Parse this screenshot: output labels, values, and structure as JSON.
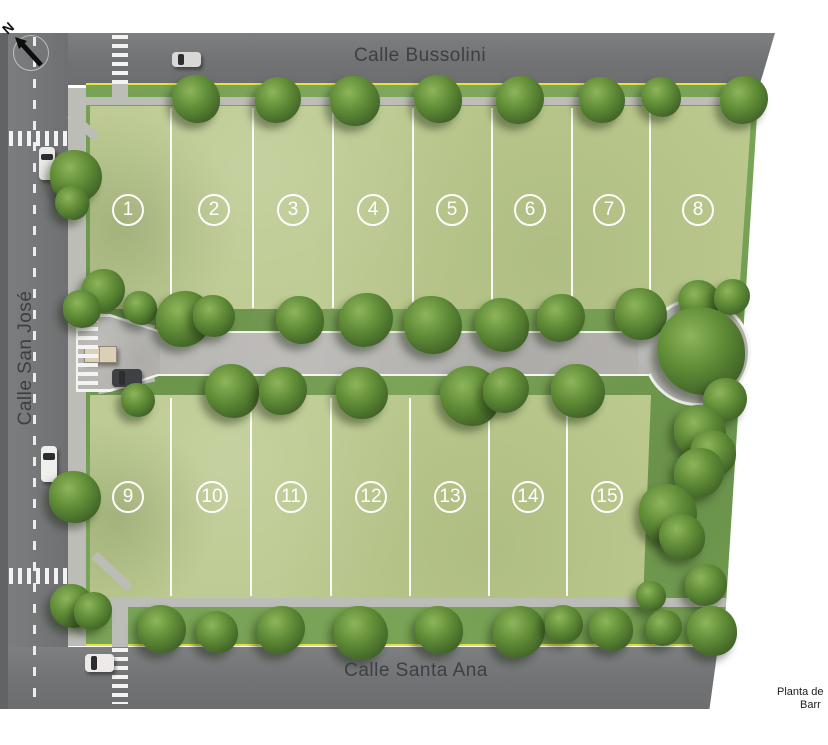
{
  "streets": {
    "top": "Calle Bussolini",
    "left": "Calle San José",
    "bottom": "Calle Santa Ana"
  },
  "caption": {
    "line1": "Planta de",
    "line2": "Barr"
  },
  "compass": {
    "label": "N"
  },
  "colors": {
    "road": "#707274",
    "internal_street": "#b6b5b2",
    "sidewalk": "#bdbdb7",
    "lot_grass": "#bbc98f",
    "verge_green": "#79a356",
    "tree_green": "#4a7030",
    "curb_yellow": "#e3e43e",
    "marker_white": "#ffffff",
    "label_text": "#3d3f43"
  },
  "lots": {
    "marker_y_top": 210,
    "marker_y_bottom": 497,
    "top_row": [
      {
        "num": "1",
        "x": 128
      },
      {
        "num": "2",
        "x": 214
      },
      {
        "num": "3",
        "x": 293
      },
      {
        "num": "4",
        "x": 373
      },
      {
        "num": "5",
        "x": 452
      },
      {
        "num": "6",
        "x": 530
      },
      {
        "num": "7",
        "x": 609
      },
      {
        "num": "8",
        "x": 698
      }
    ],
    "bottom_row": [
      {
        "num": "9",
        "x": 128
      },
      {
        "num": "10",
        "x": 212
      },
      {
        "num": "11",
        "x": 291
      },
      {
        "num": "12",
        "x": 371
      },
      {
        "num": "13",
        "x": 450
      },
      {
        "num": "14",
        "x": 528
      },
      {
        "num": "15",
        "x": 607
      }
    ]
  },
  "dividers": {
    "top": {
      "xs": [
        170,
        252,
        332,
        412,
        491,
        571,
        649
      ],
      "y1": 108,
      "y2": 308
    },
    "bottom": {
      "xs": [
        170,
        250,
        330,
        409,
        488,
        566
      ],
      "y1": 398,
      "y2": 596
    }
  },
  "paths": [
    {
      "x": 86,
      "y": 97,
      "w": 661,
      "h": 8,
      "rot": 0
    },
    {
      "x": 68,
      "y": 88,
      "w": 18,
      "h": 558,
      "rot": 0
    },
    {
      "x": 86,
      "y": 598,
      "w": 640,
      "h": 9,
      "rot": 0
    },
    {
      "x": 112,
      "y": 84,
      "w": 16,
      "h": 15,
      "rot": 0
    },
    {
      "x": 112,
      "y": 606,
      "w": 16,
      "h": 41,
      "rot": 0
    },
    {
      "x": 66,
      "y": 121,
      "w": 34,
      "h": 9,
      "rot": 42
    },
    {
      "x": 88,
      "y": 567,
      "w": 48,
      "h": 9,
      "rot": 43
    },
    {
      "x": 97,
      "y": 319,
      "w": 58,
      "h": 9,
      "rot": 13
    },
    {
      "x": 97,
      "y": 379,
      "w": 58,
      "h": 9,
      "rot": -13
    }
  ],
  "crosswalks": [
    {
      "x": 112,
      "y": 35,
      "w": 16,
      "h": 49,
      "dir": "v"
    },
    {
      "x": 9,
      "y": 131,
      "w": 59,
      "h": 15,
      "dir": "h"
    },
    {
      "x": 78,
      "y": 318,
      "w": 20,
      "h": 72,
      "dir": "v"
    },
    {
      "x": 9,
      "y": 568,
      "w": 59,
      "h": 16,
      "dir": "h"
    },
    {
      "x": 112,
      "y": 648,
      "w": 16,
      "h": 56,
      "dir": "v"
    }
  ],
  "cars": [
    {
      "x": 172,
      "y": 52,
      "w": 29,
      "h": 15,
      "color": "#d8d8d6"
    },
    {
      "x": 39,
      "y": 147,
      "w": 16,
      "h": 33,
      "color": "#eaeae8"
    },
    {
      "x": 41,
      "y": 446,
      "w": 16,
      "h": 36,
      "color": "#efefed"
    },
    {
      "x": 112,
      "y": 369,
      "w": 30,
      "h": 18,
      "color": "#3f4043"
    },
    {
      "x": 85,
      "y": 654,
      "w": 29,
      "h": 18,
      "color": "#ecebe7"
    }
  ],
  "trees": [
    {
      "x": 196,
      "y": 99,
      "r": 24
    },
    {
      "x": 278,
      "y": 100,
      "r": 23
    },
    {
      "x": 355,
      "y": 101,
      "r": 25
    },
    {
      "x": 438,
      "y": 99,
      "r": 24
    },
    {
      "x": 520,
      "y": 100,
      "r": 24
    },
    {
      "x": 602,
      "y": 100,
      "r": 23
    },
    {
      "x": 661,
      "y": 97,
      "r": 20
    },
    {
      "x": 744,
      "y": 100,
      "r": 24
    },
    {
      "x": 76,
      "y": 176,
      "r": 26
    },
    {
      "x": 72,
      "y": 203,
      "r": 17
    },
    {
      "x": 103,
      "y": 291,
      "r": 22
    },
    {
      "x": 82,
      "y": 309,
      "r": 19
    },
    {
      "x": 140,
      "y": 308,
      "r": 17
    },
    {
      "x": 184,
      "y": 319,
      "r": 28
    },
    {
      "x": 214,
      "y": 316,
      "r": 21
    },
    {
      "x": 300,
      "y": 320,
      "r": 24
    },
    {
      "x": 366,
      "y": 320,
      "r": 27
    },
    {
      "x": 433,
      "y": 325,
      "r": 29
    },
    {
      "x": 502,
      "y": 325,
      "r": 27
    },
    {
      "x": 561,
      "y": 318,
      "r": 24
    },
    {
      "x": 641,
      "y": 314,
      "r": 26
    },
    {
      "x": 699,
      "y": 301,
      "r": 21
    },
    {
      "x": 732,
      "y": 297,
      "r": 18
    },
    {
      "x": 138,
      "y": 400,
      "r": 17
    },
    {
      "x": 232,
      "y": 391,
      "r": 27
    },
    {
      "x": 283,
      "y": 391,
      "r": 24
    },
    {
      "x": 362,
      "y": 393,
      "r": 26
    },
    {
      "x": 470,
      "y": 396,
      "r": 30
    },
    {
      "x": 506,
      "y": 390,
      "r": 23
    },
    {
      "x": 578,
      "y": 391,
      "r": 27
    },
    {
      "x": 701,
      "y": 351,
      "r": 44
    },
    {
      "x": 725,
      "y": 400,
      "r": 22
    },
    {
      "x": 700,
      "y": 431,
      "r": 26
    },
    {
      "x": 713,
      "y": 453,
      "r": 23
    },
    {
      "x": 699,
      "y": 473,
      "r": 25
    },
    {
      "x": 668,
      "y": 513,
      "r": 29
    },
    {
      "x": 682,
      "y": 537,
      "r": 23
    },
    {
      "x": 706,
      "y": 585,
      "r": 21
    },
    {
      "x": 651,
      "y": 596,
      "r": 15
    },
    {
      "x": 712,
      "y": 631,
      "r": 25
    },
    {
      "x": 664,
      "y": 628,
      "r": 18
    },
    {
      "x": 75,
      "y": 497,
      "r": 26
    },
    {
      "x": 72,
      "y": 606,
      "r": 22
    },
    {
      "x": 93,
      "y": 611,
      "r": 19
    },
    {
      "x": 162,
      "y": 629,
      "r": 24
    },
    {
      "x": 217,
      "y": 632,
      "r": 21
    },
    {
      "x": 281,
      "y": 630,
      "r": 24
    },
    {
      "x": 361,
      "y": 633,
      "r": 27
    },
    {
      "x": 439,
      "y": 630,
      "r": 24
    },
    {
      "x": 519,
      "y": 632,
      "r": 26
    },
    {
      "x": 564,
      "y": 624,
      "r": 19
    },
    {
      "x": 611,
      "y": 629,
      "r": 22
    }
  ]
}
